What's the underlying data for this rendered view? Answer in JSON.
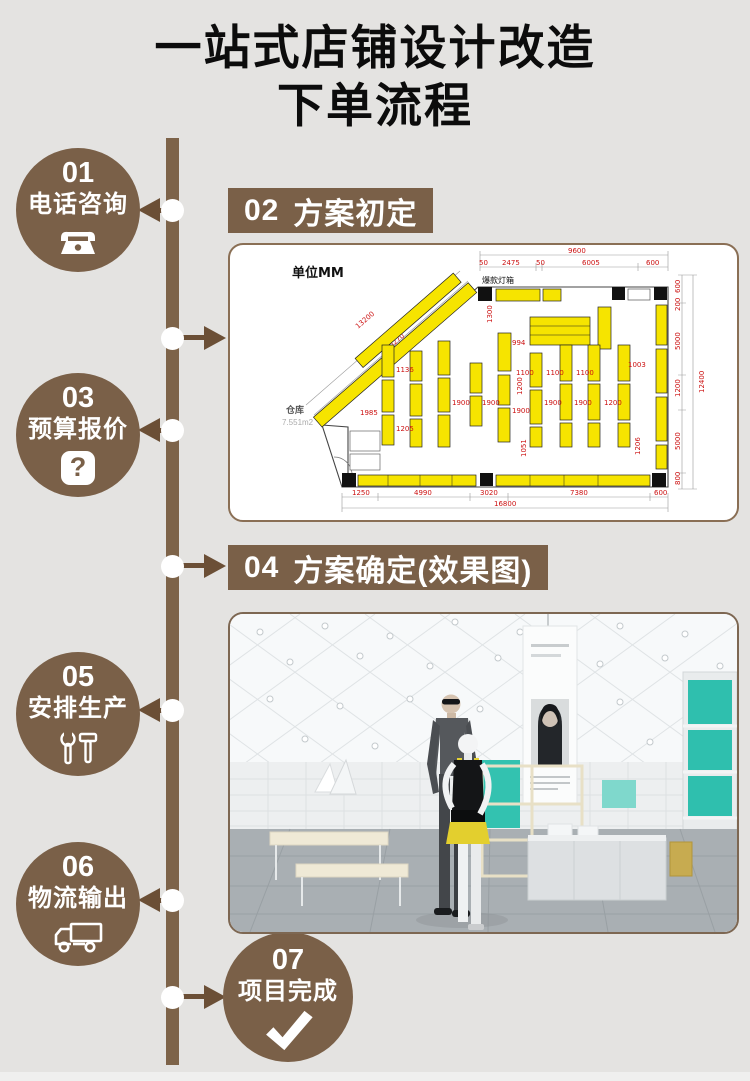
{
  "title": {
    "line1": "一站式店铺设计改造",
    "line2": "下单流程"
  },
  "colors": {
    "background": "#e4e3e1",
    "brand_brown": "#7a6048",
    "line_brown": "#7d6349",
    "arrow_brown": "#6b4f36",
    "plan_yellow": "#f6e400",
    "dim_red": "#cc1111",
    "accent_teal": "#33c2b0"
  },
  "steps": [
    {
      "num": "01",
      "label": "电话咨询",
      "icon": "phone-icon"
    },
    {
      "num": "03",
      "label": "预算报价",
      "icon": "question-icon"
    },
    {
      "num": "05",
      "label": "安排生产",
      "icon": "tools-icon"
    },
    {
      "num": "06",
      "label": "物流输出",
      "icon": "truck-icon"
    },
    {
      "num": "07",
      "label": "项目完成",
      "icon": "check-icon"
    }
  ],
  "icons": {
    "question_glyph": "?"
  },
  "sections": [
    {
      "num": "02",
      "label": "方案初定"
    },
    {
      "num": "04",
      "label": "方案确定(效果图)"
    }
  ],
  "floor_plan": {
    "unit_label": "单位MM",
    "lightbox_label": "爆款灯箱",
    "warehouse_label": "仓库",
    "warehouse_area": "7.551m2",
    "dims_top": {
      "total": "9600",
      "segs": [
        "50",
        "2475",
        "50",
        "6005",
        "600"
      ]
    },
    "dims_right": {
      "total": "12400",
      "segs": [
        "600",
        "200",
        "5000",
        "1200",
        "5000",
        "800"
      ]
    },
    "dims_bottom": {
      "total": "16800",
      "segs": [
        "1250",
        "4990",
        "3020",
        "7380",
        "600"
      ]
    },
    "dims_diagonal": [
      "13200",
      "10270"
    ],
    "dims_inner": [
      "1300",
      "994",
      "1100",
      "1100",
      "1100",
      "1003",
      "1200",
      "1136",
      "1985",
      "1205",
      "1900",
      "1900",
      "1900",
      "1900",
      "1900",
      "1200",
      "1051",
      "1206"
    ]
  }
}
